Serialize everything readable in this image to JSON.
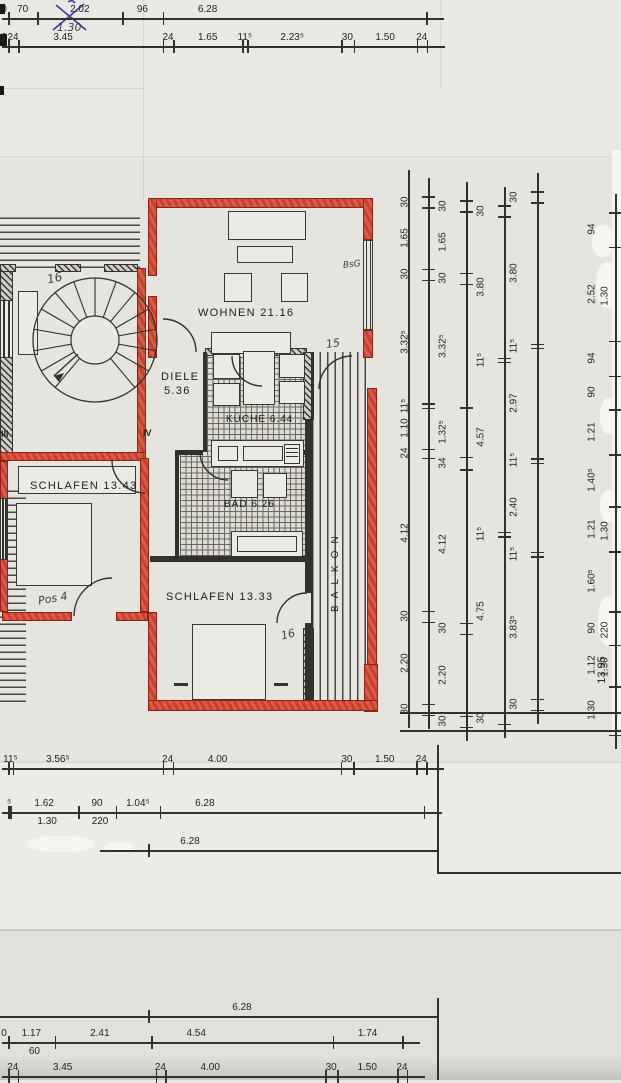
{
  "rooms": {
    "wohnen": "WOHNEN 21.16",
    "diele_name": "DIELE",
    "diele_area": "5.36",
    "kueche": "KÜCHE 6.44",
    "bad": "BAD 6.26",
    "schlafen_west": "SCHLAFEN 13.43",
    "schlafen_sued": "SCHLAFEN 13.33",
    "balkon": "BALKON"
  },
  "annotations": {
    "pencil_130": "1.30",
    "stairs_16": "16",
    "bedroom_16": "16",
    "wohnen_door_15": "15",
    "pos_4": "Pos 4",
    "bsg": "BsG",
    "window_iii": "III",
    "window_iv": "IV"
  },
  "dimensions": {
    "top_row_1": [
      "0",
      "70",
      "2.02",
      "96",
      "6.28"
    ],
    "top_row_2": [
      "0",
      "24",
      "3.45",
      "24",
      "1.65",
      "11⁵",
      "2.23⁵",
      "30",
      "1.50",
      "24"
    ],
    "right_chain_1": [
      "30",
      "1.65",
      "30",
      "3.32⁵",
      "11⁵",
      "1.10",
      "24",
      "4.12",
      "30",
      "2.20",
      "30"
    ],
    "right_chain_2": [
      "30",
      "1.65",
      "30",
      "3.32⁵",
      "1.32⁵",
      "34",
      "4.12",
      "30",
      "2.20",
      "30"
    ],
    "right_chain_3": [
      "30",
      "3.80",
      "11⁵",
      "4.57",
      "11⁵",
      "4.75",
      "30"
    ],
    "right_chain_4": [
      "30",
      "3.80",
      "11⁵",
      "2.97",
      "11⁵",
      "2.40",
      "11⁵",
      "3.83⁵",
      "30"
    ],
    "right_chain_5": [
      "94",
      "2.52/1.30",
      "94",
      "90",
      "1.21",
      "1.40⁵",
      "1.21/1.30",
      "1.60⁵",
      "90/220",
      "1.12/1.30",
      "1.30"
    ],
    "right_chain_total": "13.95",
    "bottom1_row_1": [
      "11⁵",
      "3.56⁵",
      "24",
      "4.00",
      "30",
      "1.50",
      "24"
    ],
    "bottom1_row_2": [
      "⁵",
      "1.62/1.30",
      "90/220",
      "1.04⁵",
      "6.28"
    ],
    "bottom1_row_3": "6.28",
    "bottom2_header": "6.28",
    "bottom2_row_1": [
      "0",
      "1.17/60",
      "2.41",
      "4.54",
      "1.74"
    ],
    "bottom2_row_2": [
      "24",
      "3.45",
      "24",
      "4.00",
      "30",
      "1.50",
      "24"
    ]
  },
  "colors": {
    "wall_red": "#c7402e",
    "ink": "#26241f",
    "pencil": "#44413c",
    "pen_blue": "#3b3b9c",
    "paper": "#e7e5e0"
  }
}
